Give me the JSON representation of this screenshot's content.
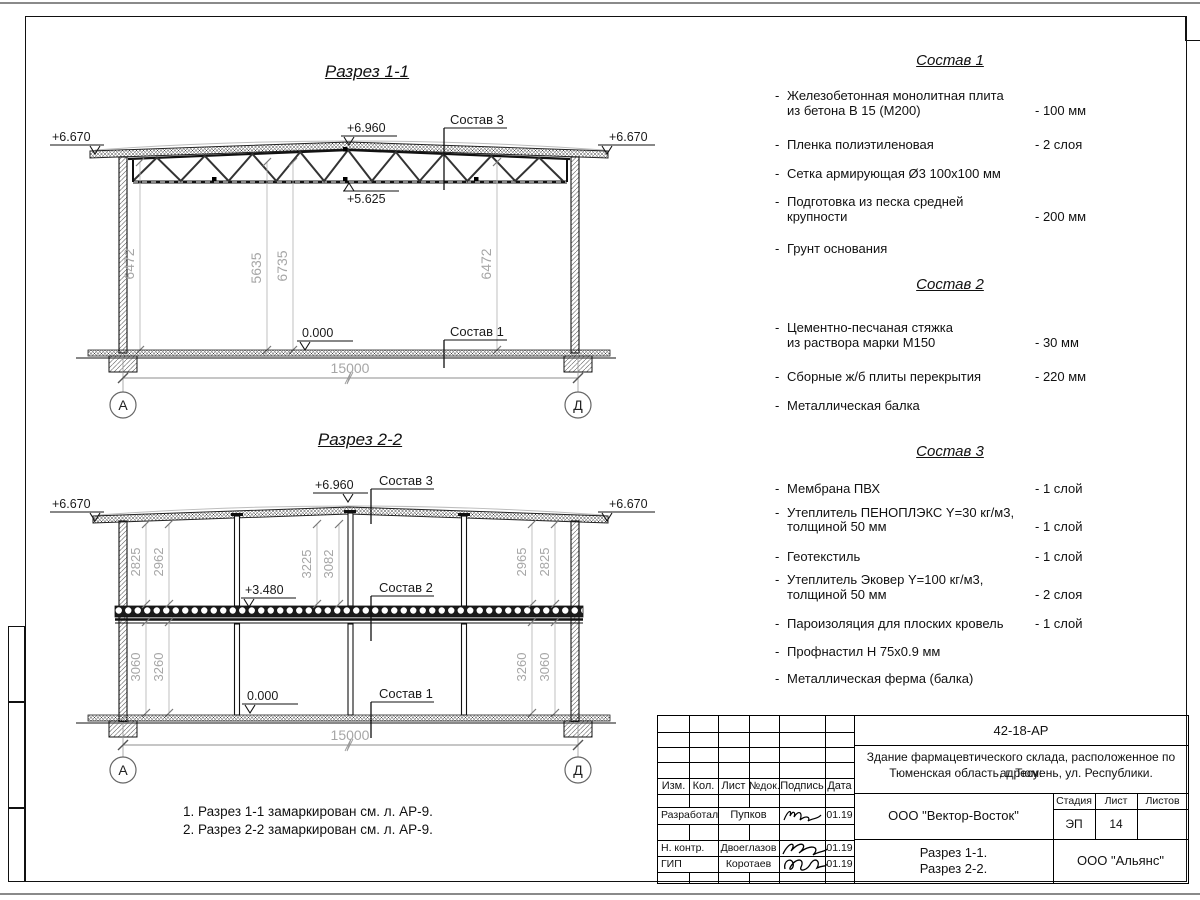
{
  "section1": {
    "title": "Разрез 1-1",
    "elev_left": "+6.670",
    "elev_right": "+6.670",
    "elev_ridge": "+6.960",
    "elev_truss": "+5.625",
    "elev_floor": "0.000",
    "label_roof": "Состав 3",
    "label_floor": "Состав 1",
    "dims": [
      "6472",
      "5635",
      "6735",
      "6472"
    ],
    "span": "15000",
    "axis_left": "А",
    "axis_right": "Д"
  },
  "section2": {
    "title": "Разрез 2-2",
    "elev_left": "+6.670",
    "elev_right": "+6.670",
    "elev_ridge": "+6.960",
    "elev_slab": "+3.480",
    "elev_floor": "0.000",
    "label_roof": "Состав 3",
    "label_slab": "Состав 2",
    "label_floor": "Состав 1",
    "dims_upper": [
      "2825",
      "2962",
      "3225",
      "3082",
      "2965",
      "2825"
    ],
    "dims_lower": [
      "3060",
      "3260",
      "3260",
      "3060"
    ],
    "span": "15000",
    "axis_left": "А",
    "axis_right": "Д"
  },
  "compositions": [
    {
      "title": "Состав 1",
      "items": [
        {
          "name": "Железобетонная  монолитная плита\nиз бетона В 15 (М200)",
          "value": "- 100 мм"
        },
        {
          "name": "Пленка полиэтиленовая",
          "value": "-  2 слоя"
        },
        {
          "name": "Сетка армирующая Ø3 100х100 мм",
          "value": ""
        },
        {
          "name": "Подготовка из песка средней\nкрупности",
          "value": "- 200 мм"
        },
        {
          "name": "Грунт основания",
          "value": ""
        }
      ]
    },
    {
      "title": "Состав 2",
      "items": [
        {
          "name": "Цементно-песчаная стяжка\nиз раствора марки М150",
          "value": "- 30 мм"
        },
        {
          "name": "Сборные ж/б плиты перекрытия",
          "value": "- 220 мм"
        },
        {
          "name": "Металлическая балка",
          "value": ""
        }
      ]
    },
    {
      "title": "Состав 3",
      "items": [
        {
          "name": "Мембрана ПВХ",
          "value": "- 1 слой"
        },
        {
          "name": "Утеплитель ПЕНОПЛЭКС Y=30 кг/м3,\nтолщиной 50 мм",
          "value": "- 1 слой"
        },
        {
          "name": "Геотекстиль",
          "value": "- 1 слой"
        },
        {
          "name": "Утеплитель Эковер Y=100 кг/м3,\nтолщиной 50 мм",
          "value": "- 2 слоя"
        },
        {
          "name": "Пароизоляция для плоских кровель",
          "value": "- 1 слой"
        },
        {
          "name": "Профнастил Н 75х0.9 мм",
          "value": ""
        },
        {
          "name": "Металлическая ферма (балка)",
          "value": ""
        }
      ]
    }
  ],
  "notes": [
    "1. Разрез 1-1 замаркирован см. л. АР-9.",
    "2. Разрез 2-2 замаркирован см. л. АР-9."
  ],
  "titleblock": {
    "doc_number": "42-18-АР",
    "desc_line1": "Здание фармацевтического склада, расположенное по адресу:",
    "desc_line2": "Тюменская область, г. Тюмень, ул. Республики.",
    "col_izm": "Изм.",
    "col_kol": "Кол.",
    "col_list": "Лист",
    "col_ndok": "№док.",
    "col_podpis": "Подпись",
    "col_data": "Дата",
    "row1_role": "Разработал",
    "row1_name": "Пупков",
    "row1_date": "01.19",
    "row2_role": "Н. контр.",
    "row2_name": "Двоеглазов",
    "row2_date": "01.19",
    "row3_role": "ГИП",
    "row3_name": "Коротаев",
    "row3_date": "01.19",
    "company": "ООО \"Вектор-Восток\"",
    "stage_label": "Стадия",
    "sheet_label": "Лист",
    "sheets_label": "Листов",
    "stage": "ЭП",
    "sheet_num": "14",
    "sheets_total": "",
    "content_line1": "Разрез 1-1.",
    "content_line2": "Разрез 2-2.",
    "org": "ООО \"Альянс\""
  }
}
